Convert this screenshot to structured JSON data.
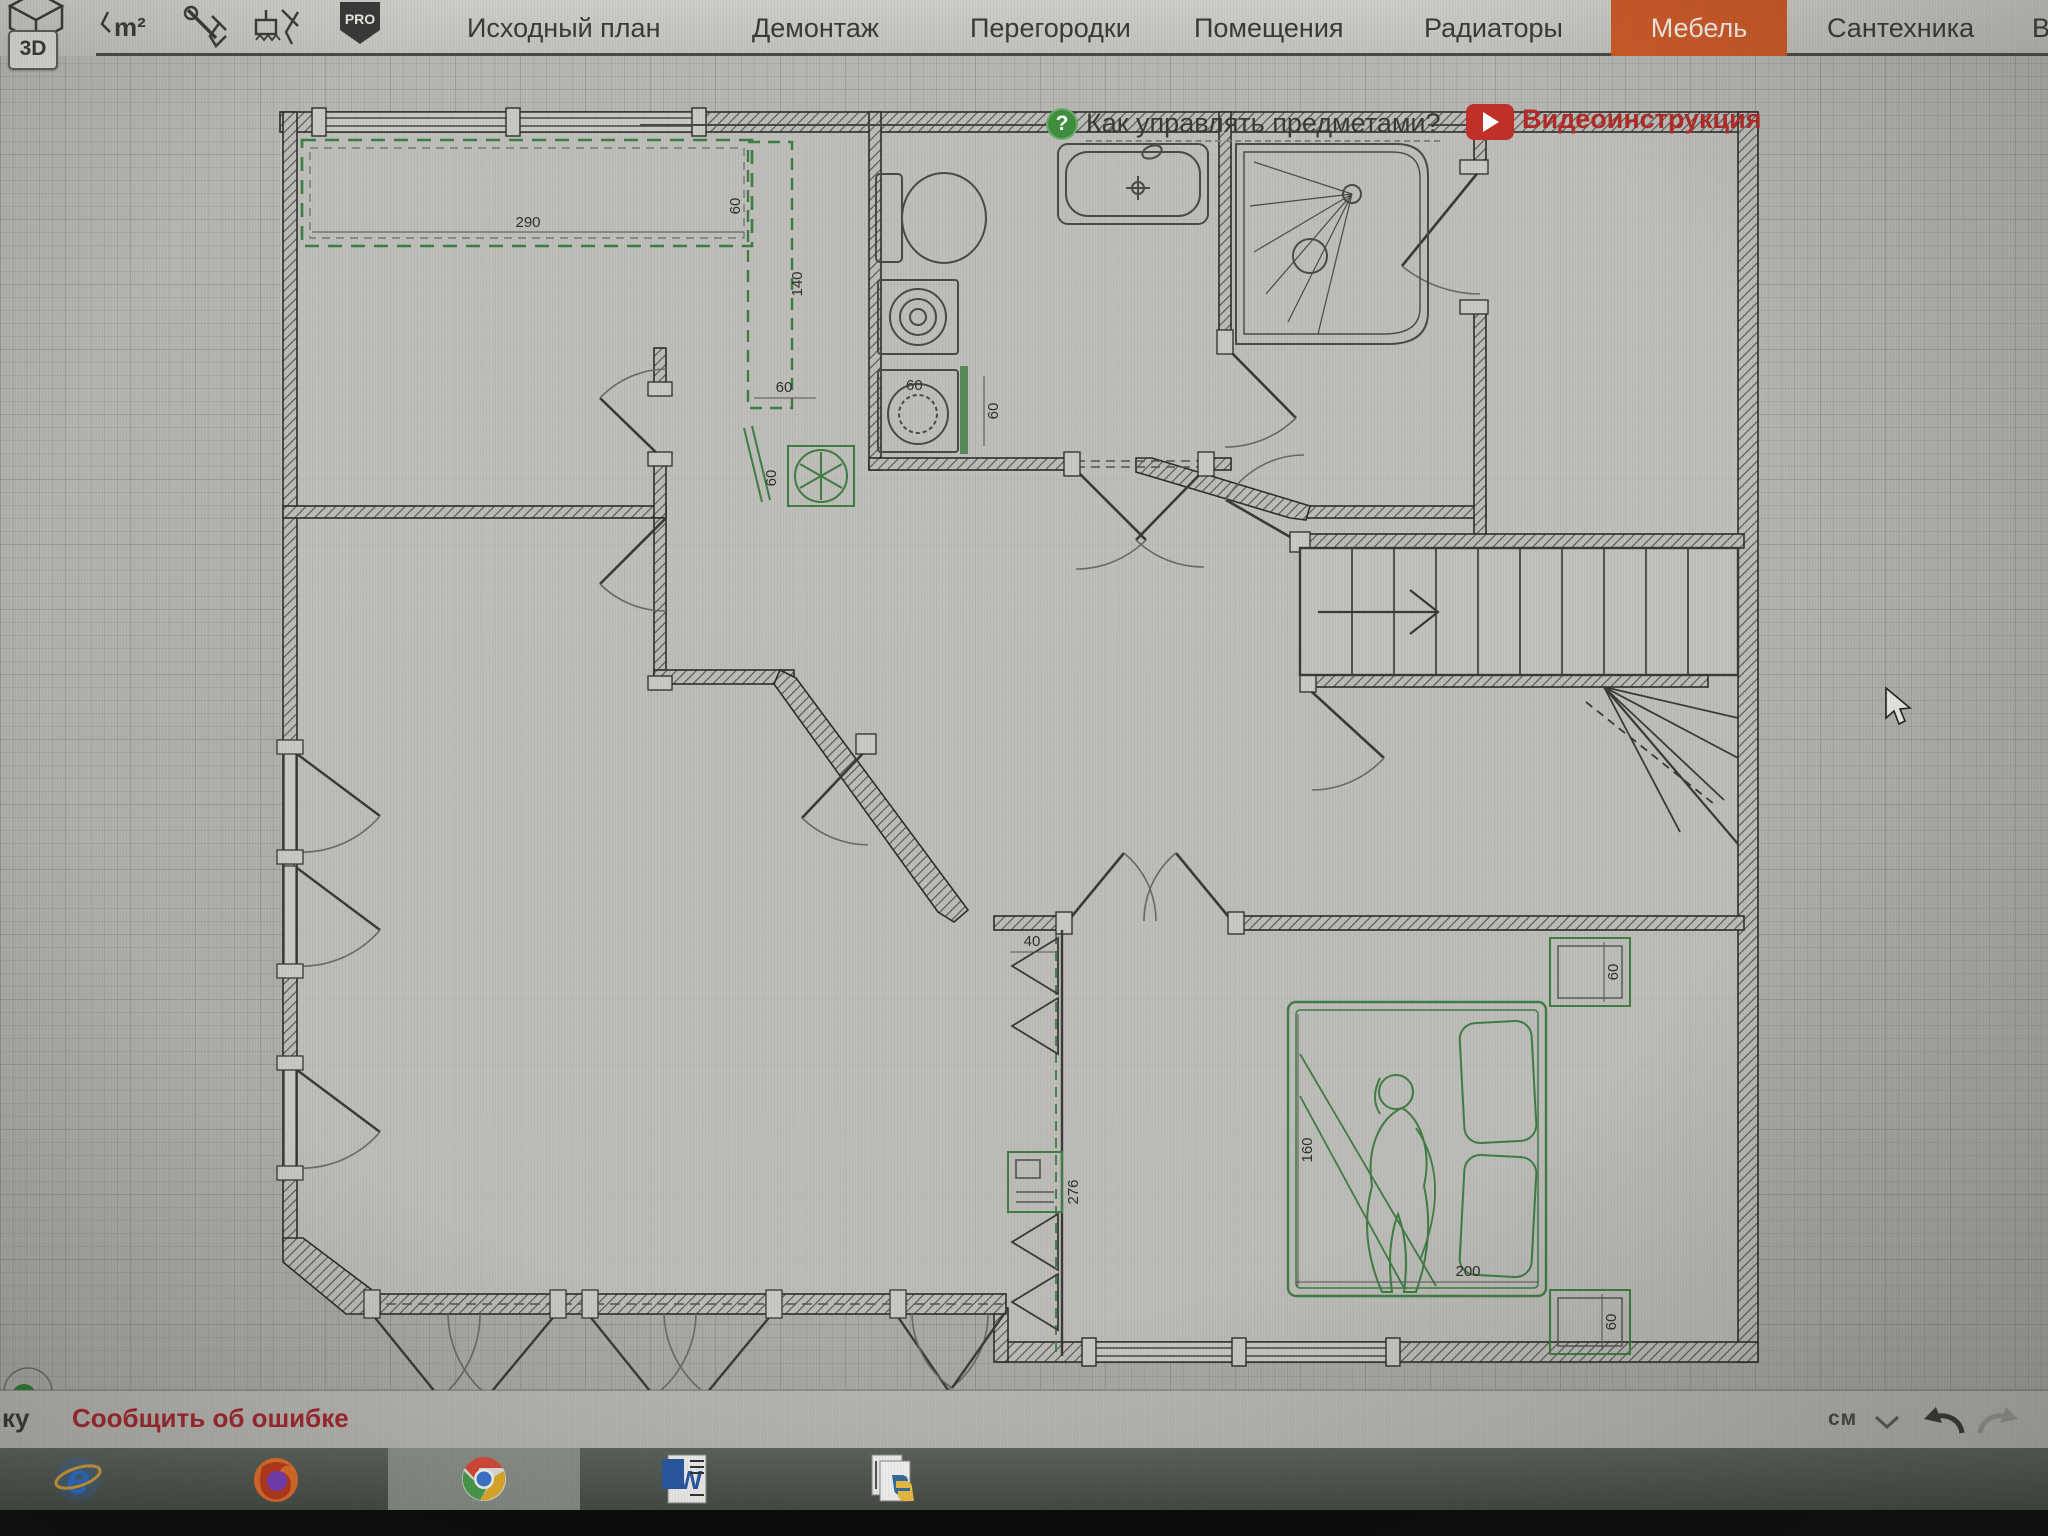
{
  "toolbar": {
    "view3d": "3D",
    "area_icon_label": "m²",
    "pro_badge": "PRO",
    "tabs": [
      {
        "label": "Исходный план"
      },
      {
        "label": "Демонтаж"
      },
      {
        "label": "Перегородки"
      },
      {
        "label": "Помещения"
      },
      {
        "label": "Радиаторы"
      },
      {
        "label": "Мебель",
        "active": true
      },
      {
        "label": "Сантехника"
      },
      {
        "label": "В"
      }
    ],
    "active_tab_color": "#cd5a28"
  },
  "canvas": {
    "help_icon_glyph": "?",
    "help_label": "Как управлять предметами?",
    "video_label": "Видеоинструкция",
    "video_icon": "youtube-play",
    "plan_dims": {
      "counter_width": "290",
      "counter_depth": "60",
      "counter_return_length": "140",
      "fridge_clearance": "60",
      "fridge_width": "60",
      "washer_width": "60",
      "washer_side": "60",
      "closet_width": "40",
      "closet_length": "276",
      "bed_length": "160",
      "bed_width": "200",
      "nightstand_top": "60",
      "nightstand_bottom": "60"
    },
    "fixtures": [
      "kitchen-counter",
      "refrigerator",
      "washing-machine",
      "dryer",
      "toilet",
      "bathtub",
      "shower-cabin",
      "staircase",
      "winder-stairs",
      "wardrobe",
      "desk",
      "double-bed",
      "nightstand",
      "nightstand",
      "person-figure"
    ]
  },
  "statusbar": {
    "left_text": "ку",
    "report_error": "Сообщить об ошибке",
    "units": "см",
    "units_dropdown_icon": "chevron-down",
    "undo_icon": "undo-arrow",
    "redo_icon": "redo-arrow"
  },
  "taskbar": {
    "items": [
      {
        "icon": "internet-explorer",
        "glyph": "e"
      },
      {
        "icon": "firefox",
        "glyph": ""
      },
      {
        "icon": "chrome",
        "glyph": "",
        "active": true
      },
      {
        "icon": "word",
        "glyph": "W"
      },
      {
        "icon": "python-files",
        "glyph": ""
      }
    ]
  }
}
